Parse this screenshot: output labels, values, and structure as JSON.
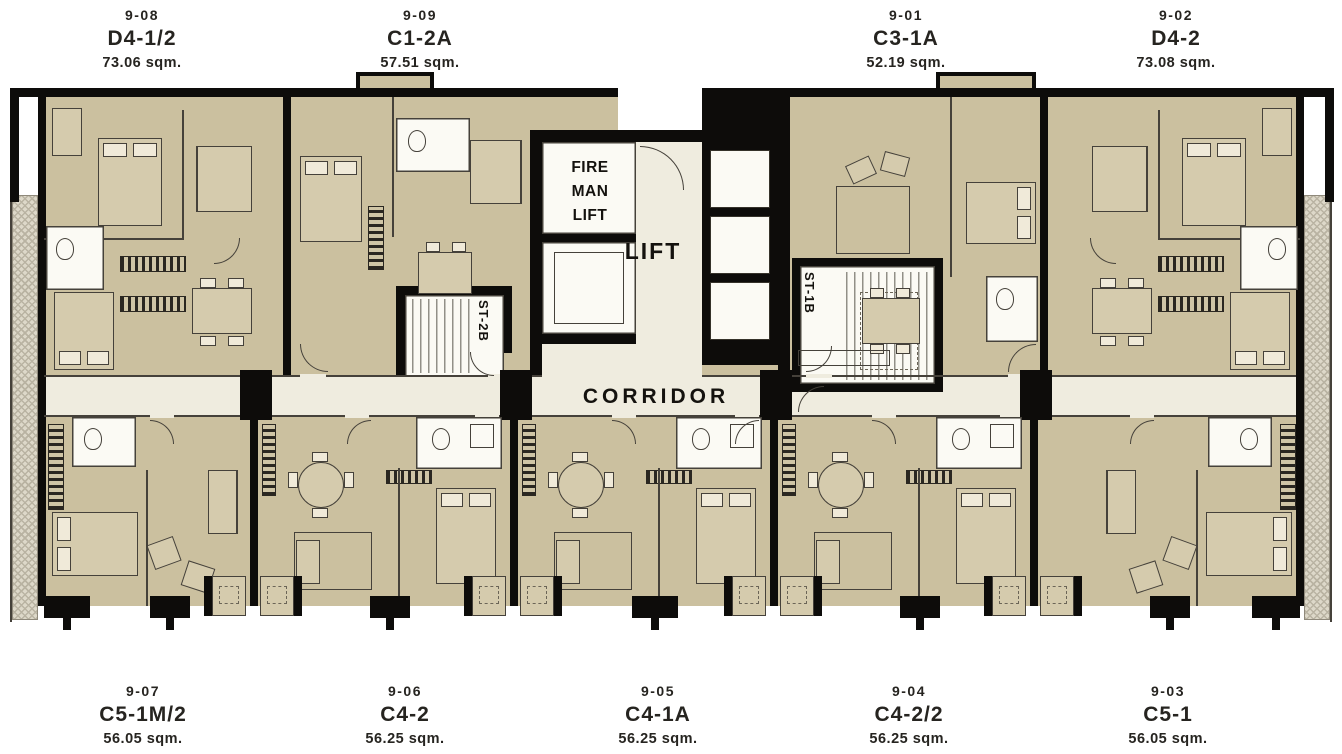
{
  "units_top": [
    {
      "id": "9-08",
      "type": "D4-1/2",
      "area": "73.06 sqm."
    },
    {
      "id": "9-09",
      "type": "C1-2A",
      "area": "57.51 sqm."
    },
    {
      "id": "9-01",
      "type": "C3-1A",
      "area": "52.19 sqm."
    },
    {
      "id": "9-02",
      "type": "D4-2",
      "area": "73.08 sqm."
    }
  ],
  "units_bottom": [
    {
      "id": "9-07",
      "type": "C5-1M/2",
      "area": "56.05 sqm."
    },
    {
      "id": "9-06",
      "type": "C4-2",
      "area": "56.25 sqm."
    },
    {
      "id": "9-05",
      "type": "C4-1A",
      "area": "56.25 sqm."
    },
    {
      "id": "9-04",
      "type": "C4-2/2",
      "area": "56.25 sqm."
    },
    {
      "id": "9-03",
      "type": "C5-1",
      "area": "56.05 sqm."
    }
  ],
  "core": {
    "fireman_lines": [
      "FIRE",
      "MAN",
      "LIFT"
    ],
    "lift": "LIFT",
    "stair_left": "ST-2B",
    "stair_right": "ST-1B",
    "corridor": "CORRIDOR"
  },
  "colors": {
    "wall": "#0d0c0a",
    "unit_floor": "#cbc09f",
    "corridor_floor": "#efecdf",
    "fixture_white": "#fbfaf4",
    "furniture_fill": "#d5cbad",
    "line": "#45413a",
    "balcony": "#ddd8c9",
    "text": "#262420"
  }
}
